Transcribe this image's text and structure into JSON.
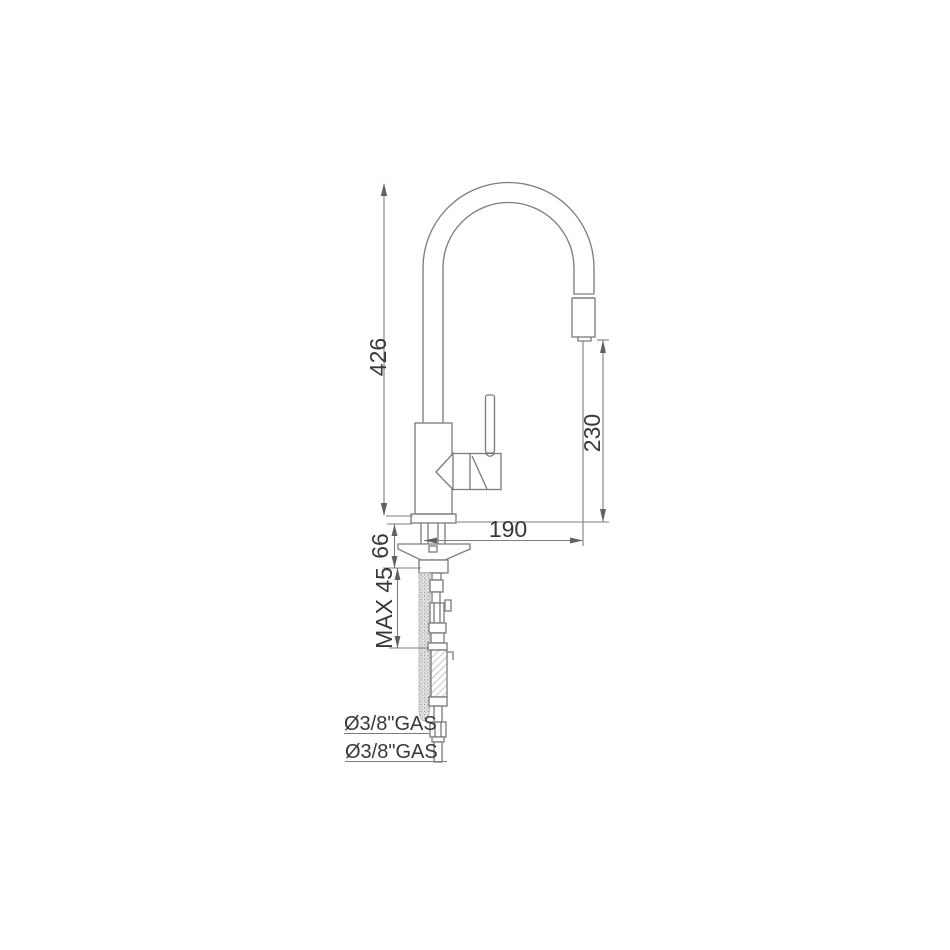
{
  "drawing": {
    "type": "faucet-technical-dimension-drawing",
    "dimensions": {
      "total_height": "426",
      "spout_outlet_height": "230",
      "spout_reach": "190",
      "base_section_height": "66",
      "max_counter_thickness": "MAX 45",
      "inlet_connection_top": "Ø3/8\"GAS",
      "inlet_connection_bottom": "Ø3/8\"GAS"
    },
    "colors": {
      "background": "#ffffff",
      "line": "#7e7e7e",
      "text": "#383838"
    }
  }
}
